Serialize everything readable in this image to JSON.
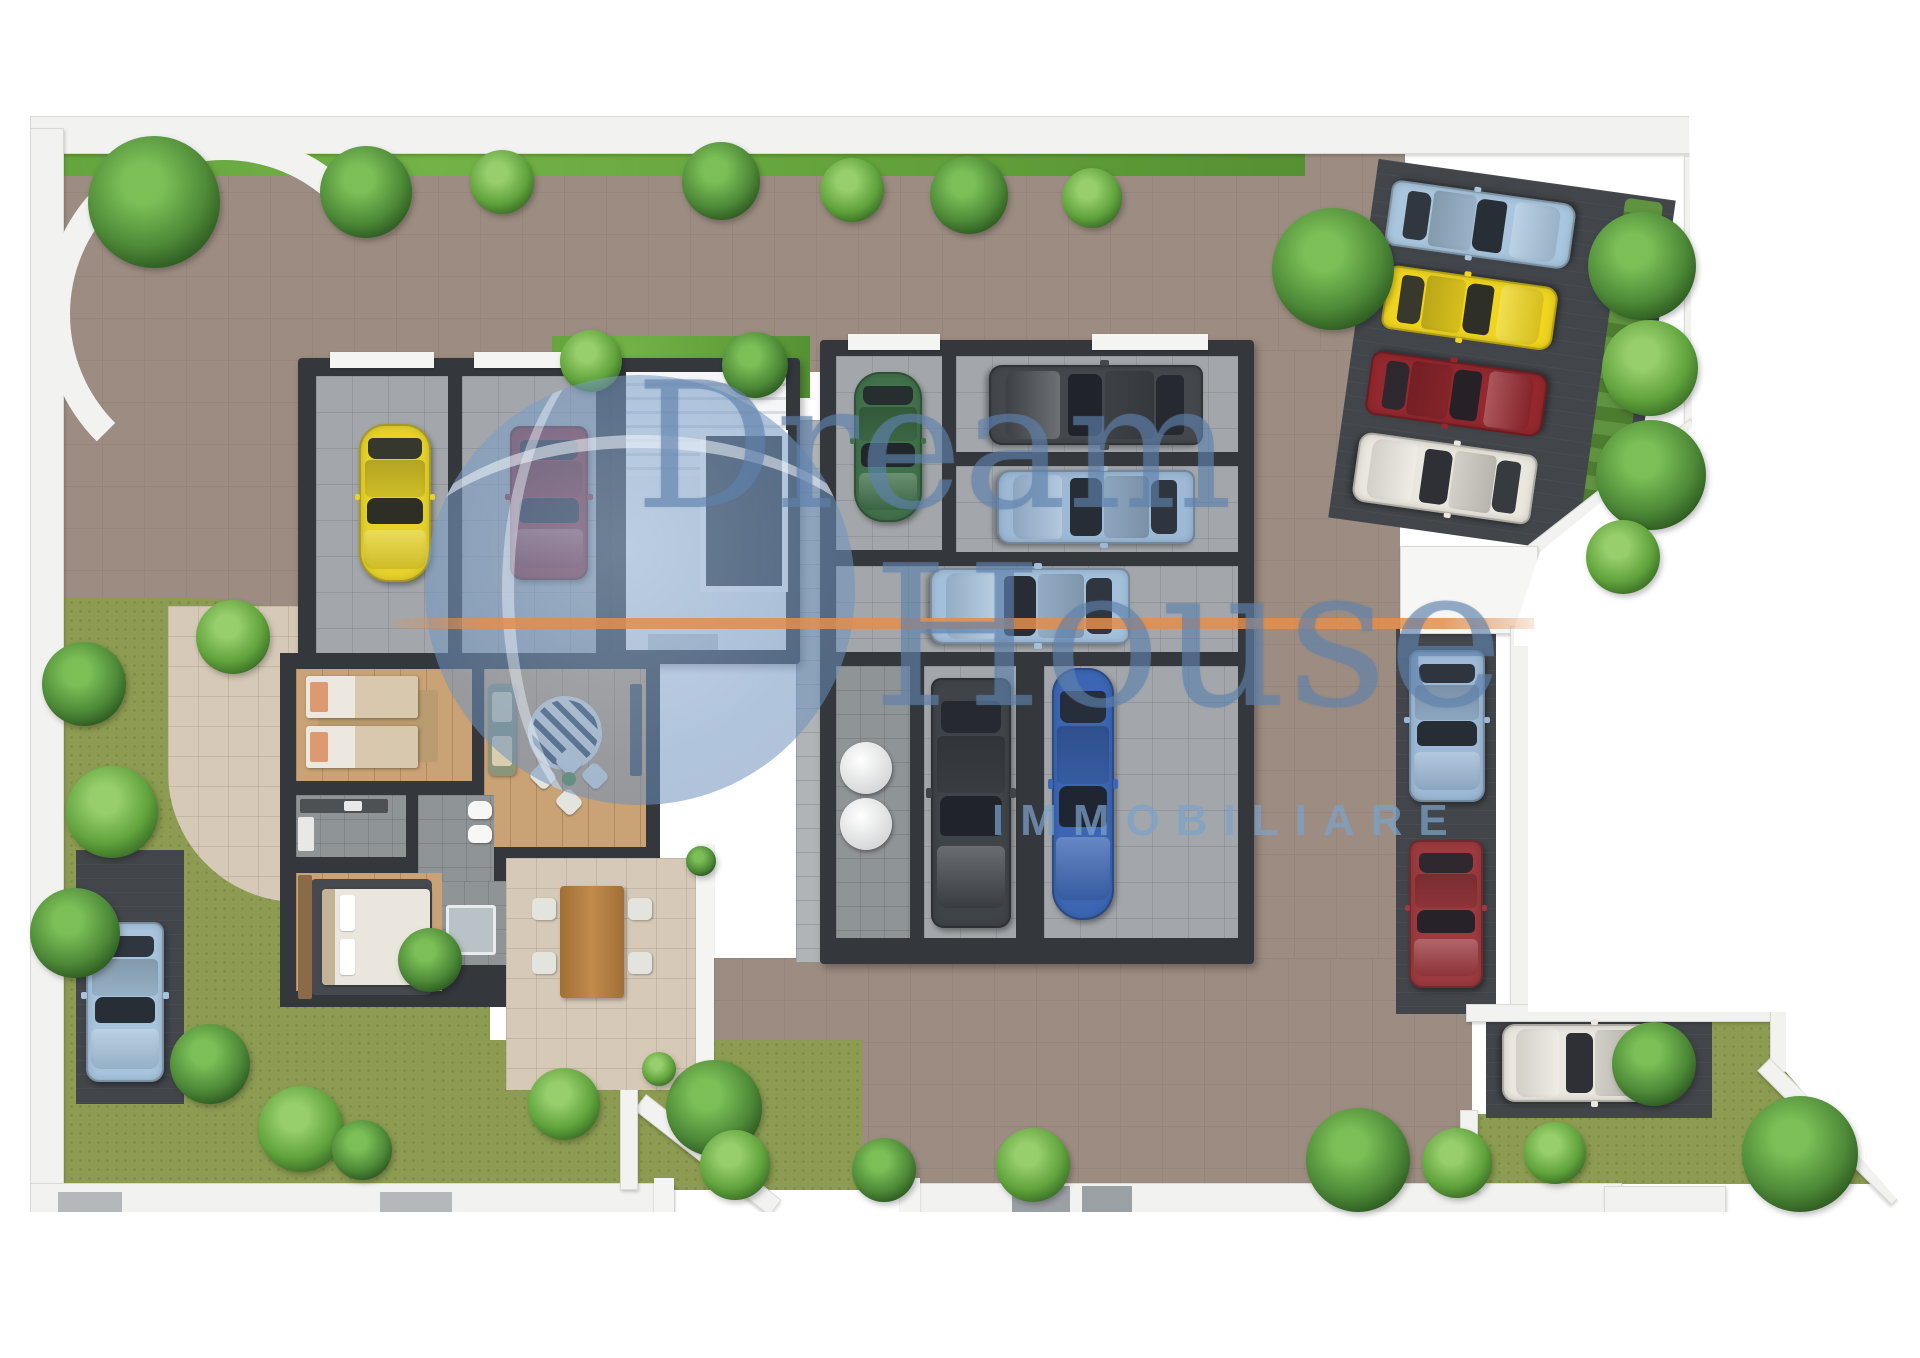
{
  "watermark": {
    "word1": "Dream",
    "word2": "House",
    "word3": "IMMOBILIARE",
    "text_color": "#5f82ac",
    "accent_line_color": "#e28e4d",
    "globe_color": "#8fb0d2"
  },
  "palette": {
    "driveway_paving": "#9c8c81",
    "garden_grass": "#8d9c52",
    "lawn_strip": "#5d9c38",
    "asphalt_parking": "#42464a",
    "building_walls": "#34373b",
    "perimeter_walls": "#f2f2f0",
    "garage_floor": "#a3a7ab",
    "apartment_wood_floor": "#c9a276",
    "patio_tiles": "#d6c9b7"
  },
  "scene": {
    "type": "3D ground-floor site plan render",
    "areas": [
      "perimeter wall with curved north-west corner",
      "large paved driveway",
      "north-east angled outdoor parking with hedge",
      "east outdoor parking strip with canopy",
      "south-east parking pad with garden",
      "west garden with parking pad",
      "central garage block",
      "left garage building",
      "staircase core",
      "ground-floor apartment with patio",
      "technical room with two tanks"
    ],
    "rooms": [
      "garage bay 1",
      "garage bay 2",
      "garage bay 3",
      "garage bay 4",
      "garage bay 5",
      "garage bay 6",
      "garage bay 7",
      "garage bay 8",
      "stairwell",
      "twin bedroom",
      "living room",
      "kitchen",
      "bathroom",
      "master bedroom",
      "technical room",
      "dining patio"
    ],
    "cars": [
      {
        "color": "#e6d22b",
        "type": "classic car",
        "location": "left garage bay 1"
      },
      {
        "color": "#8e3036",
        "type": "sedan",
        "location": "left garage bay 2"
      },
      {
        "color": "#41714b",
        "type": "classic car",
        "location": "central garage upper-left bay"
      },
      {
        "color": "#44484d",
        "type": "sports car",
        "location": "central garage upper-right bay"
      },
      {
        "color": "#9db9d6",
        "type": "sedan",
        "location": "central garage middle bay"
      },
      {
        "color": "#a3c0da",
        "type": "suv",
        "location": "central garage lower-middle bay"
      },
      {
        "color": "#3f4449",
        "type": "suv",
        "location": "central garage bottom-left bay"
      },
      {
        "color": "#3c66b4",
        "type": "classic car",
        "location": "central garage bottom-right bay"
      },
      {
        "color": "#9db9d6",
        "type": "suv",
        "location": "east parking strip upper slot"
      },
      {
        "color": "#9c3a3f",
        "type": "suv",
        "location": "east parking strip lower slot"
      },
      {
        "color": "#a9c6de",
        "type": "suv",
        "location": "north-east angled parking slot 1"
      },
      {
        "color": "#efd520",
        "type": "hatchback",
        "location": "north-east angled parking slot 2"
      },
      {
        "color": "#93282e",
        "type": "suv",
        "location": "north-east angled parking slot 3"
      },
      {
        "color": "#eae7de",
        "type": "suv",
        "location": "north-east angled parking slot 4"
      },
      {
        "color": "#eae7de",
        "type": "wagon",
        "location": "south-east parking pad"
      },
      {
        "color": "#a7c4dc",
        "type": "sedan",
        "location": "west garden parking pad"
      }
    ]
  }
}
